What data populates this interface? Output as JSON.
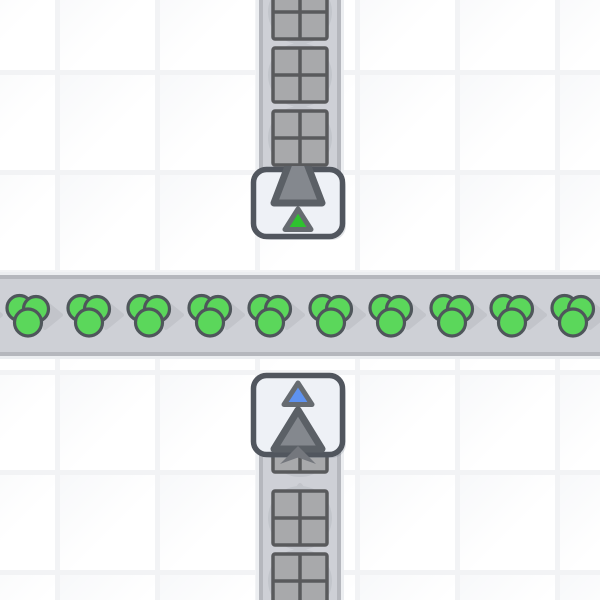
{
  "scene": {
    "description": "factory-automation game viewport: underground belt carrying square items upward beneath a horizontal conveyor of green circle items",
    "colors": {
      "grid_line": "#f2f3f5",
      "tile_shade": "#f7f8fa",
      "belt_body": "#ced0d6",
      "belt_edge": "#b5b7bd",
      "belt_halo": "#eceef1",
      "belt_arrow": "#c2c4ca",
      "item_shadow": "#c2c5cb",
      "square_item_fill": "#a8a9ab",
      "square_item_outline": "#595a5c",
      "circle_item_fill": "#5bd75b",
      "circle_item_outline": "#4f565b",
      "building_fill": "#eef1f6",
      "building_outline": "#51565e",
      "building_shadow": "rgba(90,100,115,0.18)",
      "big_arrow_fill": "#84888e",
      "big_arrow_outline": "#5b6066",
      "tunnel_mouth": "#74777d",
      "marker_green": "#2ec22e",
      "marker_blue": "#5e92f0",
      "marker_outline": "#666b70"
    },
    "grid": {
      "tile_size": 100,
      "line_offset_x": 55,
      "line_offset_y": 70
    },
    "belts": [
      {
        "id": "conveyor-belt-top",
        "orientation": "vertical",
        "direction": "up",
        "x": 259,
        "y": 0,
        "width": 82,
        "height": 172,
        "arrows": [
          51,
          114,
          177
        ],
        "items": [
          {
            "type": "square",
            "pos": 12
          },
          {
            "type": "square",
            "pos": 75
          },
          {
            "type": "square",
            "pos": 138
          }
        ]
      },
      {
        "id": "conveyor-belt-main",
        "orientation": "horizontal",
        "direction": "right",
        "x": 0,
        "y": 275,
        "width": 600,
        "height": 81,
        "arrows": [
          -8,
          52,
          112.5,
          173,
          233.5,
          294,
          354.5,
          415,
          475.5,
          536,
          596.5
        ],
        "items": [
          {
            "type": "circle-cluster",
            "pos": 28
          },
          {
            "type": "circle-cluster",
            "pos": 88.5
          },
          {
            "type": "circle-cluster",
            "pos": 149
          },
          {
            "type": "circle-cluster",
            "pos": 209.5
          },
          {
            "type": "circle-cluster",
            "pos": 270
          },
          {
            "type": "circle-cluster",
            "pos": 330.5
          },
          {
            "type": "circle-cluster",
            "pos": 391
          },
          {
            "type": "circle-cluster",
            "pos": 451.5
          },
          {
            "type": "circle-cluster",
            "pos": 512
          },
          {
            "type": "circle-cluster",
            "pos": 572.5
          }
        ]
      },
      {
        "id": "conveyor-belt-bottom",
        "orientation": "vertical",
        "direction": "up",
        "x": 259,
        "y": 450,
        "width": 82,
        "height": 150,
        "arrows": [
          494,
          557
        ],
        "items": [
          {
            "type": "square",
            "pos": 445
          },
          {
            "type": "square",
            "pos": 518
          },
          {
            "type": "square",
            "pos": 581
          }
        ]
      }
    ],
    "buildings": [
      {
        "id": "tunnel-exit-building",
        "kind": "tunnel-exit",
        "x": 250,
        "y": 166,
        "width": 96,
        "height": 74,
        "arrow_direction": "up",
        "marker": "marker_green"
      },
      {
        "id": "tunnel-entrance-building",
        "kind": "tunnel-entrance",
        "x": 250,
        "y": 372,
        "width": 96,
        "height": 86,
        "arrow_direction": "up",
        "marker": "marker_blue",
        "mouth": {
          "x": 276,
          "y": 444
        }
      }
    ]
  }
}
